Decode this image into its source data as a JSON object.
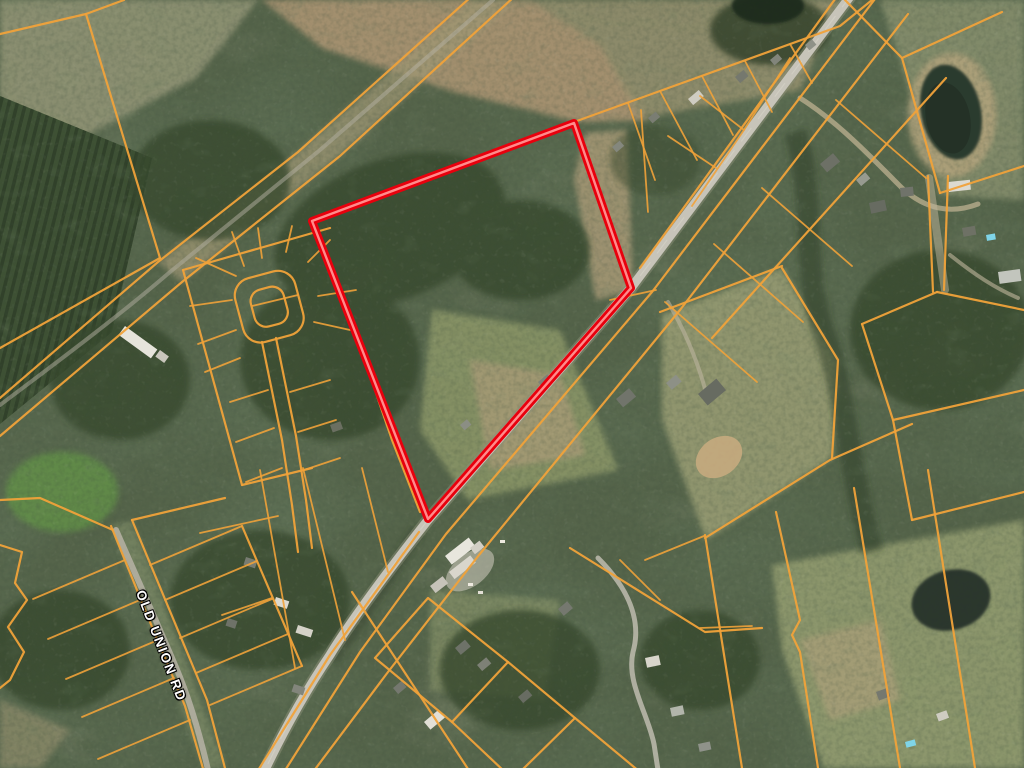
{
  "map": {
    "road_label": "OLD UNION RD",
    "colors": {
      "parcel_line": "#f0a23a",
      "highlight_outline": "#e8000d",
      "highlight_core": "#ff8b8b",
      "road": "#c7c4b9",
      "water": "#2c3a2d"
    }
  }
}
